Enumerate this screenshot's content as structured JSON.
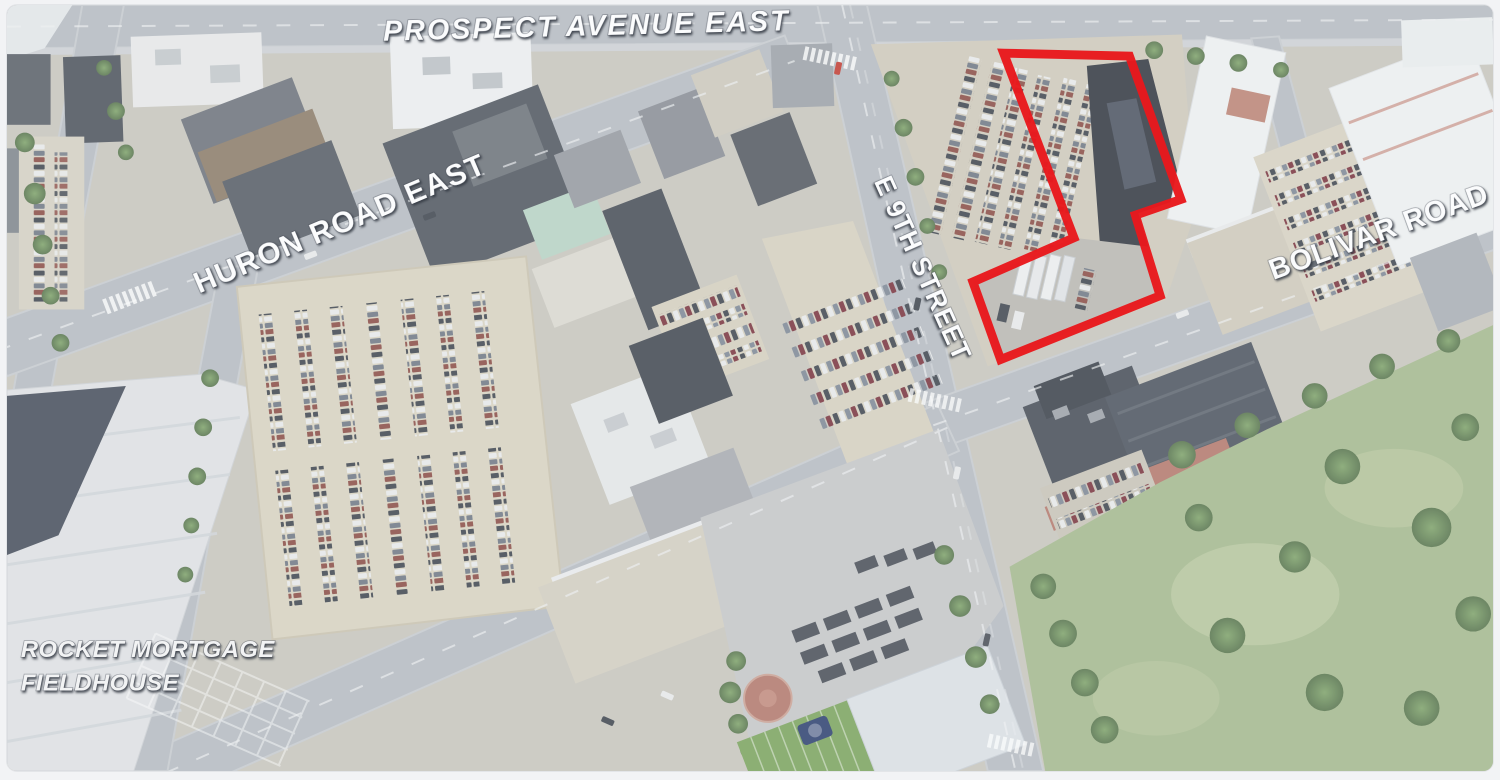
{
  "map": {
    "street_labels": [
      {
        "id": "prospect",
        "text": "PROSPECT AVENUE EAST"
      },
      {
        "id": "huron",
        "text": "HURON ROAD EAST"
      },
      {
        "id": "e9th",
        "text": "E 9TH STREET"
      },
      {
        "id": "bolivar",
        "text": "BOLIVAR ROAD"
      }
    ],
    "landmark_label": {
      "line1": "ROCKET MORTGAGE",
      "line2": "FIELDHOUSE"
    },
    "highlight": {
      "color": "#e8191d",
      "stroke_width": 9,
      "points": "1006,49 1133,52 1185,198 1139,214 1164,296 1003,361 975,282 1077,237"
    },
    "palette": {
      "road": "#b5bac1",
      "parking": "#d8d2c0",
      "building_dark": "#4a505a",
      "building_light": "#eceef0",
      "grass": "#a4b88d",
      "tree": "#5d8049",
      "brick": "#b3766a",
      "haze": "#eef1f4"
    }
  }
}
